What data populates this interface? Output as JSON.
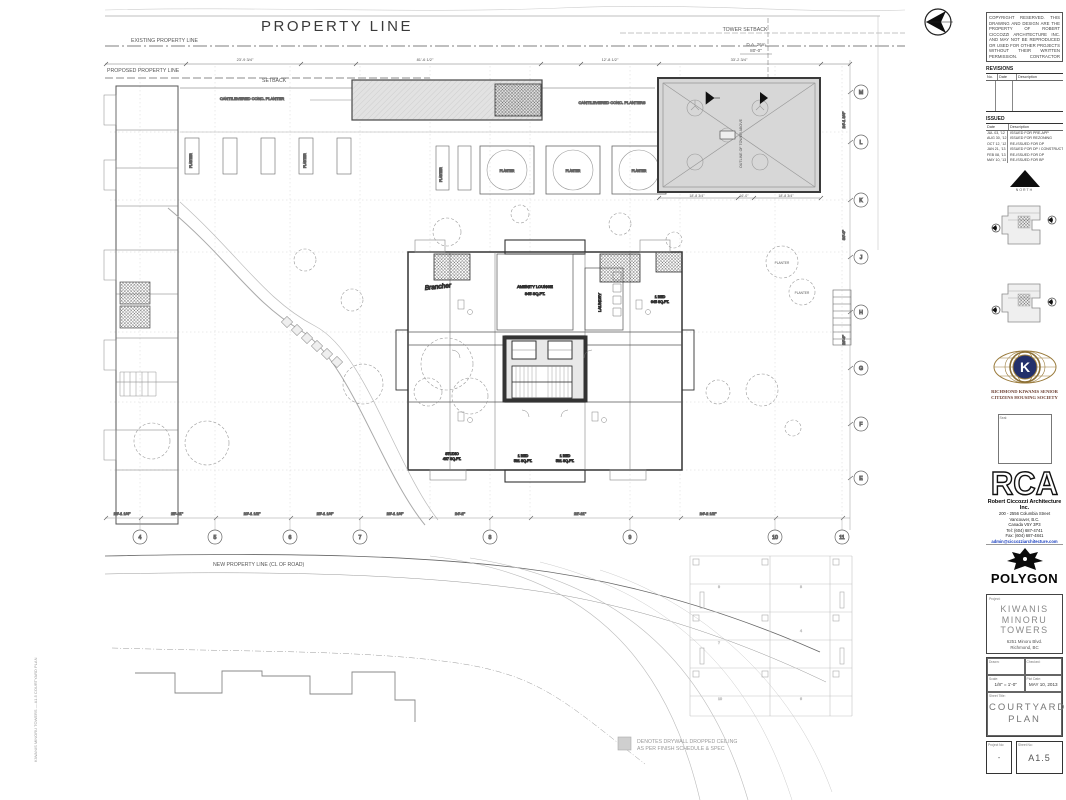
{
  "plan": {
    "property_line": "PROPERTY LINE",
    "existing_property_line": "EXISTING PROPERTY LINE",
    "proposed_property_line": "PROPOSED PROPERTY LINE",
    "setback": "SETBACK",
    "tower_setback": "TOWER SETBACK",
    "tower_setback_note": "D.A. 26m",
    "tower_setback_dim": "80'-0\"",
    "new_property_line": "NEW PROPERTY LINE (CL OF ROAD)",
    "cantilevered_planter": "CANTILEVERED CONC. PLANTER",
    "cantilevered_planters": "CANTILEVERED CONC. PLANTERS",
    "planter": "PLANTER",
    "amenity_lounge": "AMENITY LOUNGE",
    "amenity_area": "845 SQ.FT.",
    "laundry": "LAUNDRY",
    "roof_note": "OUTLINE OF TOWER ABOVE",
    "pencil_note": "Brancher",
    "units": [
      {
        "name": "STUDIO",
        "area": "437 SQ.FT."
      },
      {
        "name": "1 BED",
        "area": "581 SQ.FT."
      },
      {
        "name": "1 BED",
        "area": "581 SQ.FT."
      },
      {
        "name": "1 BED",
        "area": "645 SQ.FT."
      }
    ],
    "top_dims": [
      "23'-9 3/4\"",
      "81'-6 1/2\"",
      "12'-8 1/2\"",
      "33'-2 3/4\""
    ],
    "bottom_dims": [
      "23'-1 1/4\"",
      "25'-11\"",
      "20'-1 1/2\"",
      "25'-1 1/4\"",
      "23'-1 1/4\"",
      "24'-2\"",
      "22'-11\"",
      "24'-2 1/2\""
    ],
    "right_dims": [
      "24'-1 3/4\"",
      "30'-0\"",
      "26'-6\""
    ],
    "roof_dims": [
      "18'-8 3/4\"",
      "16'-0\"",
      "18'-8 3/4\""
    ],
    "grid_bottom": [
      "4",
      "5",
      "6",
      "7",
      "8",
      "9",
      "10",
      "11"
    ],
    "grid_right": [
      "M",
      "L",
      "K",
      "J",
      "H",
      "G",
      "F",
      "E"
    ],
    "parkade_labels": [
      "9",
      "7",
      "10",
      "8",
      "4",
      "6"
    ],
    "legend_line1": "DENOTES DRYWALL DROPPED CEILING",
    "legend_line2": "AS PER FINISH SCHEDULE & SPEC",
    "plot_stamp": "KIWANIS MINORU TOWERS — A1.5 COURTYARD PLAN"
  },
  "titleblock": {
    "disclaimer": "COPYRIGHT RESERVED. THIS DRAWING AND DESIGN ARE THE PROPERTY OF ROBERT CICCOZZI ARCHITECTURE INC. AND MAY NOT BE REPRODUCED OR USED FOR OTHER PROJECTS WITHOUT THEIR WRITTEN PERMISSION. CONTRACTOR SHALL VERIFY ALL DIMENSIONS AND DATUMS PRIOR TO COMMENCEMENT OF WORK AND REPORT ANY DISCREPANCIES TO THE ARCHITECT IMMEDIATELY.",
    "revisions": {
      "title": "REVISIONS",
      "col_no": "No.",
      "col_date": "Date",
      "col_desc": "Description"
    },
    "issued": {
      "title": "ISSUED",
      "col_date": "Date",
      "col_desc": "Description",
      "rows": [
        {
          "date": "JUL 03, '12",
          "desc": "ISSUED FOR PRE-APP"
        },
        {
          "date": "AUG 30, '12",
          "desc": "ISSUED FOR REZONING"
        },
        {
          "date": "OCT 12, '12",
          "desc": "RE-ISSUED FOR DP"
        },
        {
          "date": "JAN 21, '13",
          "desc": "ISSUED FOR DP / CONSTRUCTION"
        },
        {
          "date": "FEB 08, '13",
          "desc": "RE-ISSUED FOR DP"
        },
        {
          "date": "MAY 10, '13",
          "desc": "RE-ISSUED FOR BP"
        }
      ]
    },
    "north_label": "NORTH",
    "kiwanis": {
      "k": "K",
      "caption_line1": "RICHMOND KIWANIS SENIOR",
      "caption_line2": "CITIZENS HOUSING SOCIETY"
    },
    "seal_label": "Seal:",
    "rca": {
      "logo": "RCA",
      "firm": "Robert Ciccozzi Architecture Inc.",
      "address_line1": "200 - 2556 Columbia Street",
      "address_line2": "Vancouver, B.C.",
      "address_line3": "Canada  V5Y 3P3",
      "phone": "Tel: (604) 687-4741",
      "fax": "Fax: (604) 687-4841",
      "email": "admin@ciccozziarchitecture.com"
    },
    "polygon_label": "POLYGON",
    "project": {
      "label": "Project:",
      "name_line1": "KIWANIS MINORU",
      "name_line2": "TOWERS",
      "address_line1": "6251 Minoru Blvd.",
      "address_line2": "Richmond, BC"
    },
    "meta": {
      "drawn_label": "Drawn:",
      "checked_label": "Checked:",
      "scale_label": "Scale:",
      "scale_value": "1/8\" = 1'-0\"",
      "date_label": "Plot Date:",
      "date_value": "MAY 10, 2013",
      "sheet_title_label": "Sheet Title:",
      "sheet_title_line1": "COURTYARD",
      "sheet_title_line2": "PLAN",
      "project_no_label": "Project No:",
      "project_no_value": "-",
      "sheet_no_label": "Sheet No:",
      "sheet_no_value": "A1.5"
    }
  },
  "colors": {
    "shaded_area": "#d7d7d7",
    "kiwanis_navy": "#23306b",
    "kiwanis_gold": "#9a7b3c",
    "email_blue": "#1a3fbf"
  }
}
